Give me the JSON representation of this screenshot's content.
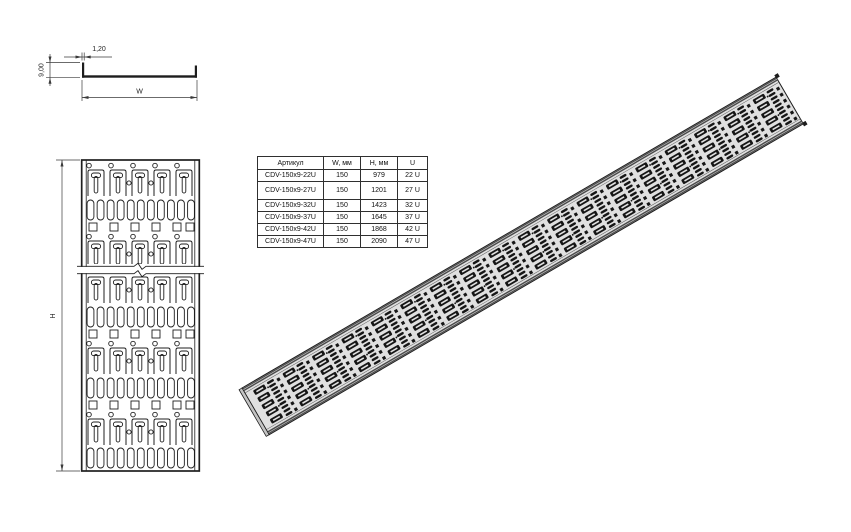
{
  "drawing": {
    "section_view": {
      "thickness_label": "1,20",
      "height_label": "9,00",
      "width_label": "W"
    },
    "front_view": {
      "height_label": "H"
    }
  },
  "table": {
    "headers": [
      "Артикул",
      "W, мм",
      "H, мм",
      "U"
    ],
    "rows": [
      [
        "CDV-150x9-22U",
        "150",
        "979",
        "22 U"
      ],
      [
        "CDV-150x9-27U",
        "150",
        "1201",
        "27 U"
      ],
      [
        "CDV-150x9-32U",
        "150",
        "1423",
        "32 U"
      ],
      [
        "CDV-150x9-37U",
        "150",
        "1645",
        "37 U"
      ],
      [
        "CDV-150x9-42U",
        "150",
        "1868",
        "42 U"
      ],
      [
        "CDV-150x9-47U",
        "150",
        "2090",
        "47 U"
      ]
    ]
  },
  "colors": {
    "line": "#1f1f1f",
    "dim_line": "#3a3a3a",
    "iso_body": "#e0e0e0",
    "iso_mark": "#161616",
    "iso_edge": "#4a4a4a",
    "iso_end": "#c4c4c4"
  }
}
